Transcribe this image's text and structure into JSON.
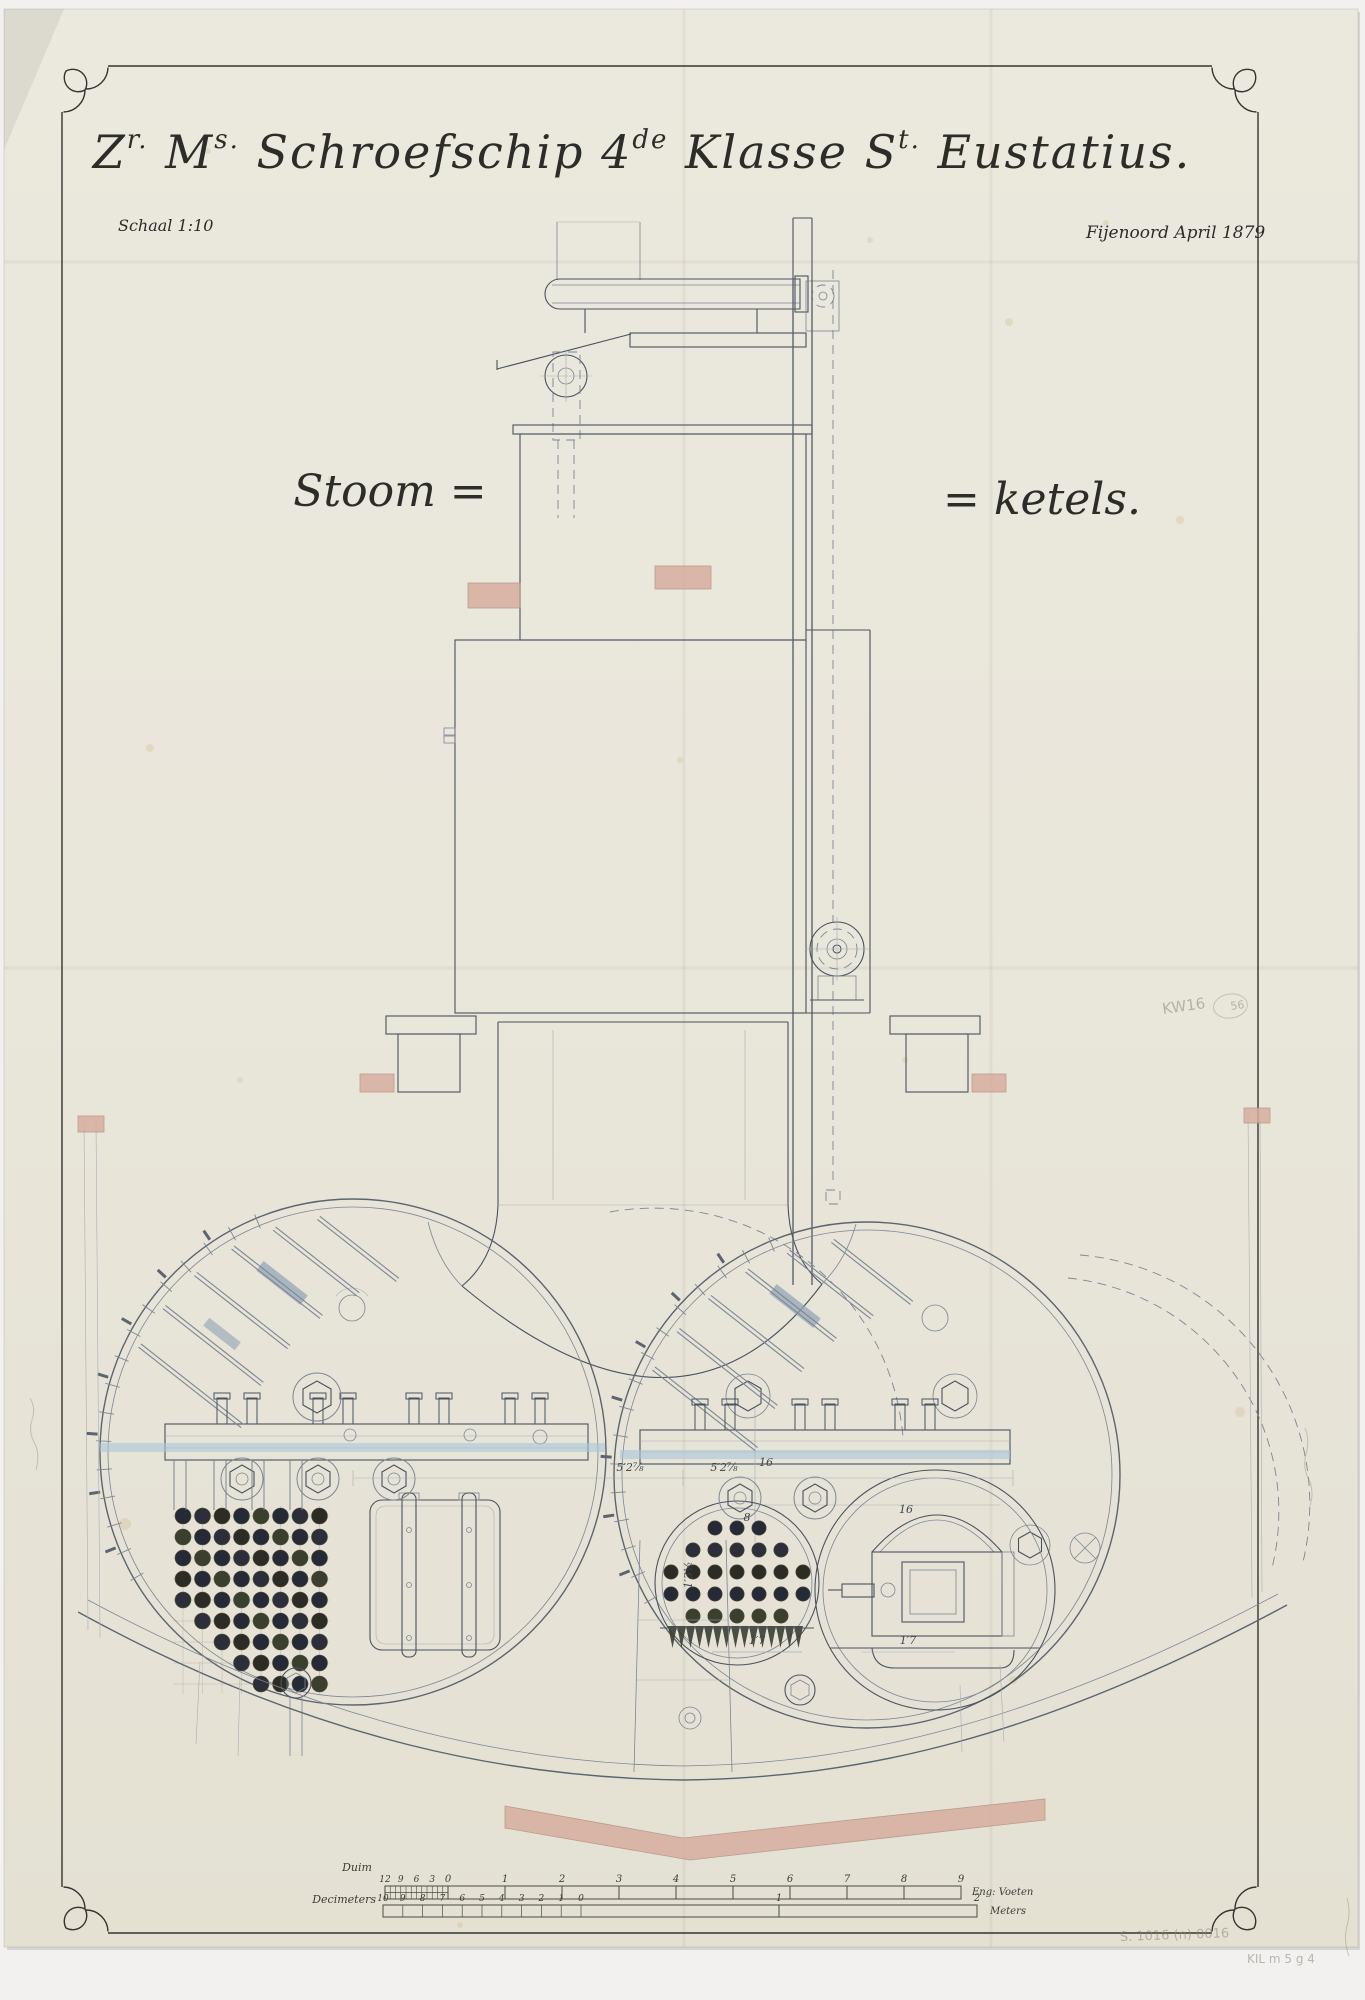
{
  "sheet": {
    "title_segments": [
      {
        "t": "Z",
        "s": "r."
      },
      {
        "t": " M",
        "s": "s."
      },
      {
        "t": " Schroefschip 4",
        "s": "de"
      },
      {
        "t": " Klasse   S",
        "s": "t."
      },
      {
        "t": " Eustatius.",
        "s": ""
      }
    ],
    "scale_note": "Schaal 1:10",
    "place_date": "Fijenoord April 1879",
    "subject_left": "Stoom =",
    "subject_right": "= ketels."
  },
  "dimensions": [
    {
      "x": 630,
      "y": 1471,
      "t": "5′2⅞"
    },
    {
      "x": 724,
      "y": 1471,
      "t": "5′2⅞"
    },
    {
      "x": 766,
      "y": 1466,
      "t": "16"
    },
    {
      "x": 747,
      "y": 1521,
      "t": "8"
    },
    {
      "x": 906,
      "y": 1513,
      "t": "16"
    },
    {
      "x": 692,
      "y": 1575,
      "t": "1′3½",
      "rot": -90
    },
    {
      "x": 757,
      "y": 1644,
      "t": "1′7"
    },
    {
      "x": 908,
      "y": 1644,
      "t": "1′7"
    }
  ],
  "rulers": {
    "duim": {
      "label": "Duim",
      "sub_numbers": [
        "12",
        "9",
        "6",
        "3"
      ],
      "numbers": [
        "0",
        "1",
        "2",
        "3",
        "4",
        "5",
        "6",
        "7",
        "8",
        "9"
      ],
      "end_label": "Eng: Voeten"
    },
    "decimeter": {
      "label": "Decimeters",
      "numbers": [
        "10",
        "9",
        "8",
        "7",
        "6",
        "5",
        "4",
        "3",
        "2",
        "1",
        "0"
      ],
      "meter_numbers": [
        "1",
        "2"
      ],
      "end_label": "Meters"
    }
  },
  "annotations": [
    {
      "x": 1163,
      "y": 1014,
      "t": "KW16",
      "rot": -8,
      "size": 15
    },
    {
      "x": 1231,
      "y": 1010,
      "t": "56",
      "rot": -8,
      "size": 11,
      "circle": true
    },
    {
      "x": 1120,
      "y": 1941,
      "t": "S. 1016 (n) 0016",
      "rot": -2,
      "size": 13
    },
    {
      "x": 1247,
      "y": 1963,
      "t": "KIL m 5 g 4",
      "rot": 0,
      "size": 12
    }
  ],
  "boiler_views": {
    "left_tube_grid": {
      "x0": 183,
      "y0": 1516,
      "dx": 19.5,
      "dy": 21,
      "cols": 8,
      "rows": 9,
      "r": 8
    },
    "right_tube_circle": {
      "cx": 737,
      "cy": 1583,
      "r": 82,
      "dot_r": 7.2,
      "pitch": 22,
      "rows": 5,
      "top": 1528
    }
  },
  "colors": {
    "paper": "#e9e6da",
    "paper2": "#e4e1d3",
    "ink": "#4a5260",
    "steel": "#5b6470",
    "light": "#7c8695",
    "xlight": "#a7aeb8",
    "blue": "#a8c6d8",
    "salmon": "#d7ae9f",
    "pencil": "#8d8679",
    "tube_palette": [
      "#252a36",
      "#252a36",
      "#2c2f3a",
      "#3a3f2e",
      "#2c2c25"
    ]
  }
}
